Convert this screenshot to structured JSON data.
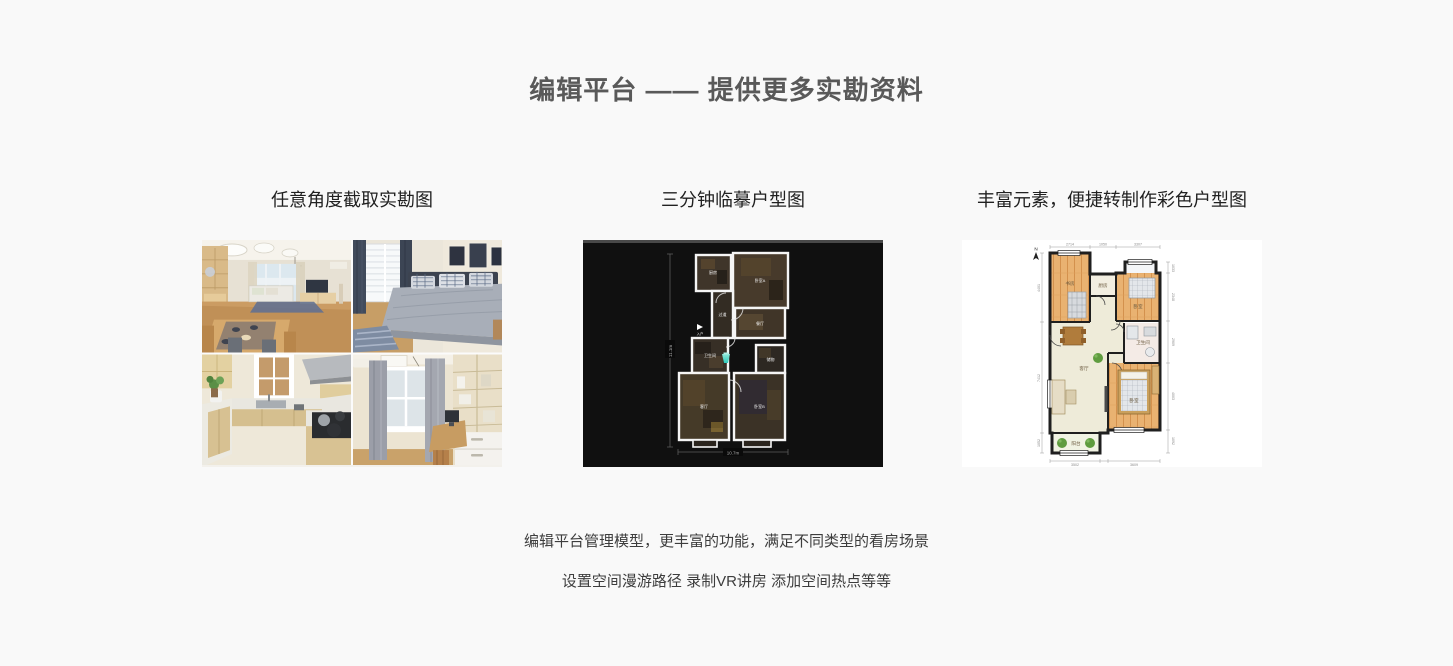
{
  "page": {
    "background_color": "#f9f9f9"
  },
  "header": {
    "title": "编辑平台 —— 提供更多实勘资料",
    "title_color": "#595959"
  },
  "features": [
    {
      "caption": "任意角度截取实勘图",
      "image_kind": "interior-photo-grid"
    },
    {
      "caption": "三分钟临摹户型图",
      "image_kind": "dark-dollhouse-floorplan"
    },
    {
      "caption": "丰富元素，便捷转制作彩色户型图",
      "image_kind": "colored-floorplan"
    }
  ],
  "footer": {
    "line1": "编辑平台管理模型，更丰富的功能，满足不同类型的看房场景",
    "line2": "设置空间漫游路径 录制VR讲房 添加空间热点等等"
  },
  "dark_floorplan": {
    "background": "#101010",
    "wall_color": "#f5f5f5",
    "marker_color": "#3fd6c4",
    "height_dim": "11.1m",
    "width_dim": "10.7m",
    "entrance_label": "入户",
    "rooms": {
      "kitchen": "厨房",
      "bedroom_a": "卧室A",
      "corridor": "过道",
      "dining": "餐厅",
      "bath": "卫生间",
      "storage": "储物",
      "living": "客厅",
      "bedroom_b": "卧室B"
    }
  },
  "color_floorplan": {
    "north_label": "N",
    "wood_color": "#e9b271",
    "rooms": {
      "study": "书房",
      "kitchen": "厨房",
      "bedroom_top": "卧室",
      "bath": "卫生间",
      "living": "客厅",
      "balcony": "阳台",
      "bedroom_bottom": "卧室"
    },
    "dims_top": [
      "2714",
      "1050",
      "3307"
    ],
    "dims_left": [
      "4401",
      "7412",
      "1052"
    ],
    "dims_right": [
      "1033",
      "2348",
      "2909",
      "4003",
      "1092"
    ],
    "dims_bottom": [
      "3502",
      "3609"
    ]
  }
}
